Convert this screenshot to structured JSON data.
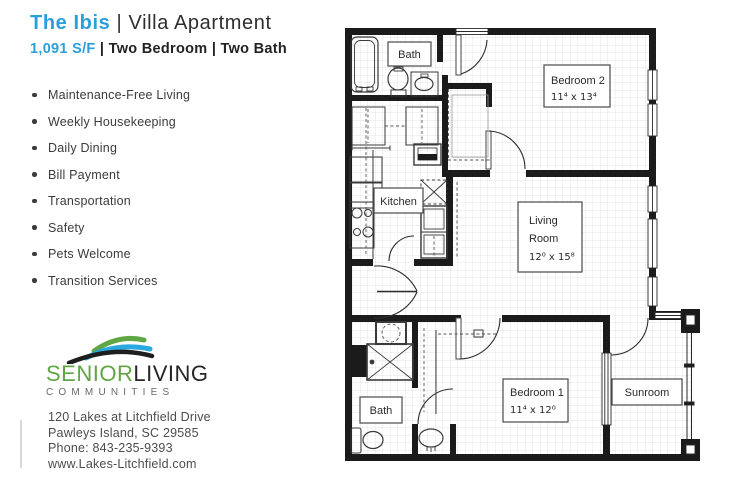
{
  "header": {
    "title_name": "The Ibis",
    "title_rest": "| Villa Apartment",
    "sqft": "1,091 S/F",
    "specs": "| Two Bedroom | Two Bath"
  },
  "amenities": [
    "Maintenance-Free Living",
    "Weekly Housekeeping",
    "Daily Dining",
    "Bill Payment",
    "Transportation",
    "Safety",
    "Pets Welcome",
    "Transition Services"
  ],
  "logo": {
    "word_part1": "SENIOR",
    "word_part2": "LIVING",
    "line2": "COMMUNITIES"
  },
  "contact": {
    "address1": "120 Lakes at Litchfield Drive",
    "address2": "Pawleys Island, SC 29585",
    "phone": "Phone: 843-235-9393",
    "website": "www.Lakes-Litchfield.com"
  },
  "floorplan": {
    "labels": {
      "bath_top": "Bath",
      "bath_bottom": "Bath",
      "kitchen": "Kitchen",
      "bedroom2_name": "Bedroom 2",
      "bedroom2_dims": "11⁴ x 13⁴",
      "living_line1": "Living",
      "living_line2": "Room",
      "living_dims": "12⁰ x 15⁸",
      "bedroom1_name": "Bedroom 1",
      "bedroom1_dims": "11⁴ x 12⁰",
      "sunroom": "Sunroom"
    }
  },
  "colors": {
    "brand_blue": "#2b9fd9",
    "logo_green": "#5fa744",
    "logo_blue": "#2aa9e0",
    "wall_black": "#1b1b1b",
    "text_dark": "#2e2e2e",
    "text_gray": "#4c4c4c"
  }
}
